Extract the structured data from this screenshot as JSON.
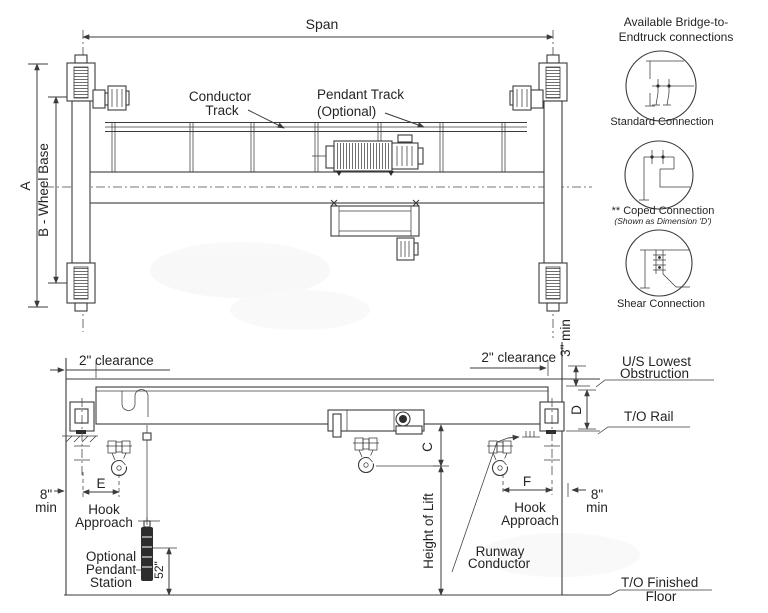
{
  "plan": {
    "span": "Span",
    "dim_a": "A",
    "wheel_base": "B - Wheel Base",
    "conductor_track": [
      "Conductor",
      "Track"
    ],
    "pendant_track": [
      "Pendant Track",
      "(Optional)"
    ]
  },
  "connections": {
    "title": [
      "Available Bridge-to-",
      "Endtruck connections"
    ],
    "standard": "Standard Connection",
    "coped": "** Coped Connection",
    "coped_note": "(Shown as Dimension 'D')",
    "shear": "Shear Connection"
  },
  "elevation": {
    "clearance_left": "2\" clearance",
    "clearance_right": "2\" clearance",
    "min3": "3\" min",
    "us_lowest": [
      "U/S Lowest",
      "Obstruction"
    ],
    "dim_d": "D",
    "to_rail": "T/O Rail",
    "dim_c": "C",
    "height_of_lift": "Height of Lift",
    "dim_e": "E",
    "dim_f": "F",
    "hook_approach_left": [
      "Hook",
      "Approach"
    ],
    "hook_approach_right": [
      "Hook",
      "Approach"
    ],
    "min8_left": [
      "8\"",
      "min"
    ],
    "min8_right": [
      "8\"",
      "min"
    ],
    "pendant_station": [
      "Optional",
      "Pendant",
      "Station"
    ],
    "dim_52": "52\"",
    "runway_conductor": [
      "Runway",
      "Conductor"
    ],
    "to_floor": [
      "T/O Finished",
      "Floor"
    ]
  },
  "colors": {
    "line": "#3b3b3b",
    "text": "#242424",
    "background": "#ffffff"
  }
}
